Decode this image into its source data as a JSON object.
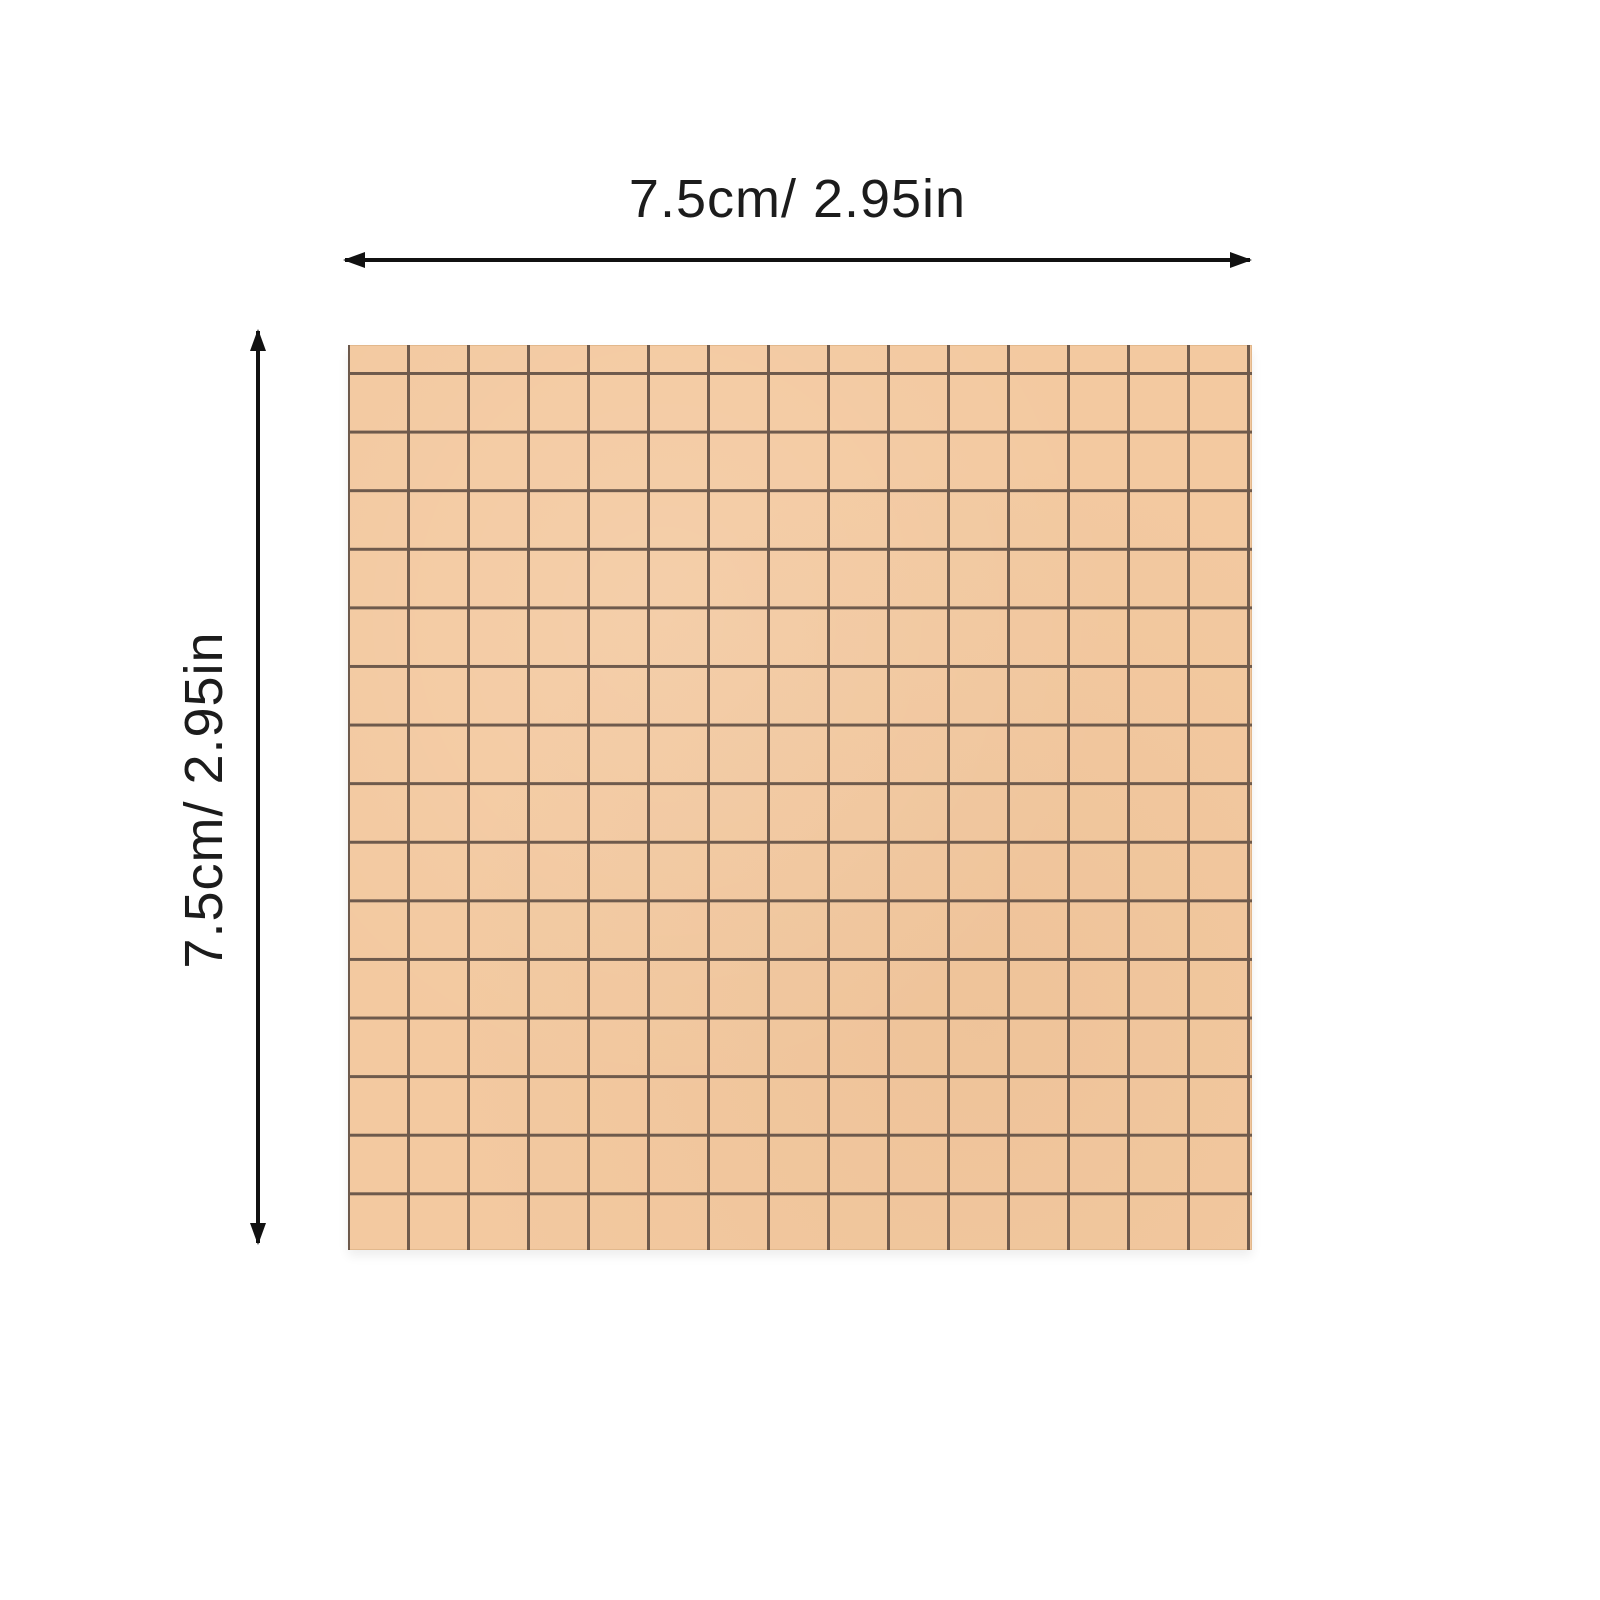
{
  "figure": {
    "type": "product-dimension-diagram",
    "product": "kraft grid sticky note pad",
    "width_label": "7.5cm/ 2.95in",
    "height_label": "7.5cm/ 2.95in",
    "width_cm": 7.5,
    "width_in": 2.95,
    "height_cm": 7.5,
    "height_in": 2.95,
    "grid_columns": 15,
    "grid_rows": 15
  },
  "colors": {
    "background": "#ffffff",
    "paper": "#f3c9a0",
    "paper_edge": "#e2b88c",
    "grid_line": "#5c4b41",
    "dimension_line": "#111111",
    "label_text": "#1c1c1c"
  }
}
